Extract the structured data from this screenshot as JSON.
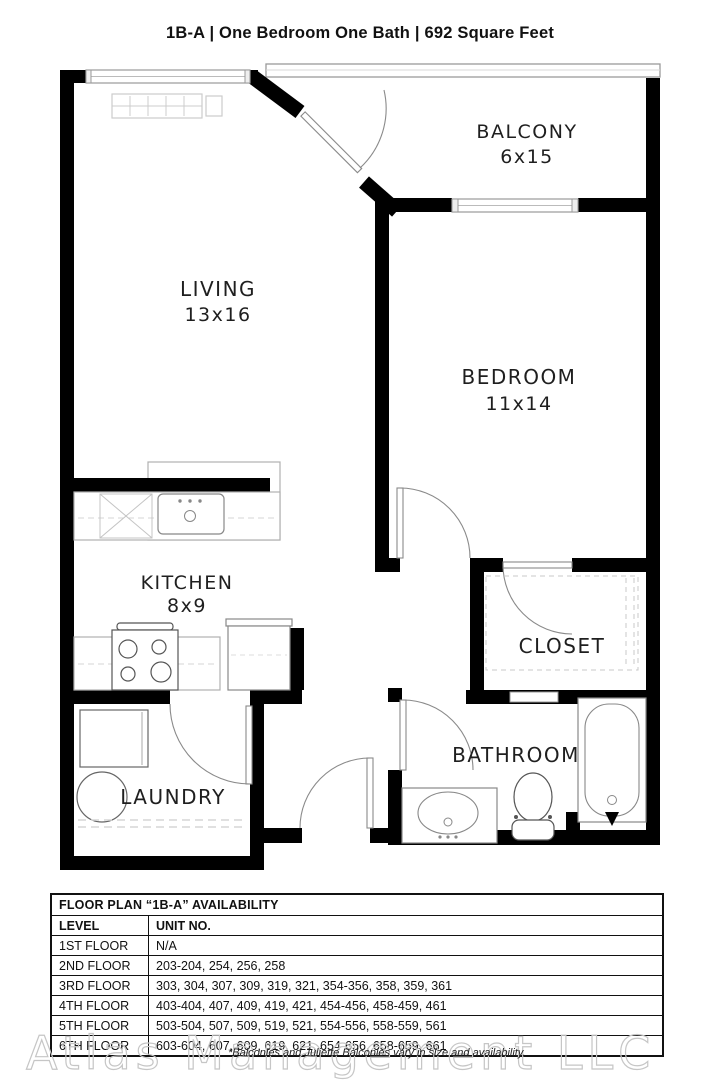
{
  "title": "1B-A | One Bedroom One Bath |  692 Square Feet",
  "unit": {
    "code": "1B-A",
    "type": "One Bedroom One Bath",
    "area": "692 Square Feet"
  },
  "floor_plan": {
    "rooms": {
      "living": {
        "label": "LIVING",
        "dims": "13x16"
      },
      "balcony": {
        "label": "BALCONY",
        "dims": "6x15"
      },
      "bedroom": {
        "label": "BEDROOM",
        "dims": "11x14"
      },
      "kitchen": {
        "label": "KITCHEN",
        "dims": "8x9"
      },
      "closet": {
        "label": "CLOSET"
      },
      "laundry": {
        "label": "LAUNDRY"
      },
      "bathroom": {
        "label": "BATHROOM"
      }
    }
  },
  "availability_table": {
    "title": "FLOOR PLAN “1B-A” AVAILABILITY",
    "columns": [
      "LEVEL",
      "UNIT NO."
    ],
    "rows": [
      {
        "level": "1ST FLOOR",
        "units": "N/A"
      },
      {
        "level": "2ND FLOOR",
        "units": "203-204, 254, 256, 258"
      },
      {
        "level": "3RD FLOOR",
        "units": "303, 304, 307, 309, 319, 321, 354-356, 358, 359, 361"
      },
      {
        "level": "4TH FLOOR",
        "units": "403-404, 407, 409, 419, 421, 454-456, 458-459, 461"
      },
      {
        "level": "5TH FLOOR",
        "units": "503-504, 507, 509, 519, 521, 554-556, 558-559, 561"
      },
      {
        "level": "6TH FLOOR",
        "units": "603-604, 607, 609, 619, 621, 654-656, 658-659, 661"
      }
    ]
  },
  "footer": {
    "watermark": "Atlas Management LLC",
    "note": "*Balconies and Juliette Balconies vary in size and availability."
  },
  "colors": {
    "wall": "#000000",
    "fixture": "#777777",
    "light_outline": "#c0c0c0"
  }
}
